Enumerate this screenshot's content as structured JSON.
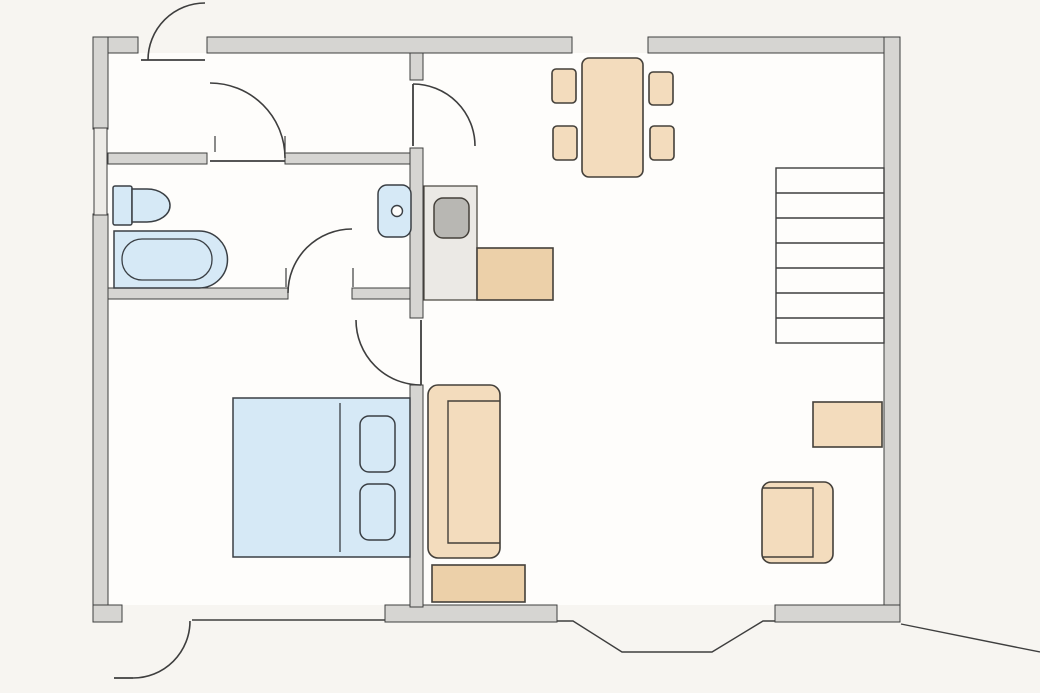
{
  "title": "apartment-floor-plan",
  "colors": {
    "exterior_bg": "#f7f5f1",
    "floor_white": "#fefdfb",
    "wall_fill": "#d6d5d2",
    "wall_stroke": "#3e3e3e",
    "window_fill": "#edebe7",
    "fixture_blue": "#d6e9f6",
    "fixture_stroke": "#3a3f44",
    "furniture_tan": "#f3dcbd",
    "furniture_tan_dark": "#ecd0a9",
    "furniture_stroke": "#44403a",
    "kitchen_unit_gray": "#ebe9e5",
    "appliance_gray": "#b8b7b3"
  },
  "stairs": {
    "steps": 7
  },
  "doors": [
    {
      "name": "back-door",
      "location": "top-left exterior wall, swings outward"
    },
    {
      "name": "hallway-bathroom-door",
      "location": "interior wall between hallway and bathroom"
    },
    {
      "name": "kitchen-door",
      "location": "interior wall between hallway and kitchen/dining area"
    },
    {
      "name": "bathroom-lower-door",
      "location": "interior wall between bathroom and bedroom area"
    },
    {
      "name": "bedroom-door",
      "location": "interior wall between bedroom and living area"
    },
    {
      "name": "front-door",
      "location": "bottom-left exterior wall, swings outward"
    }
  ],
  "windows": [
    {
      "name": "left-wall-window"
    },
    {
      "name": "top-wall-opening"
    },
    {
      "name": "bottom-picture-window"
    },
    {
      "name": "bottom-bay-window"
    }
  ],
  "furniture": [
    {
      "name": "toilet",
      "room": "bathroom"
    },
    {
      "name": "bathtub",
      "room": "bathroom"
    },
    {
      "name": "washbasin",
      "room": "bathroom"
    },
    {
      "name": "kitchen-unit",
      "room": "kitchen"
    },
    {
      "name": "stove",
      "room": "kitchen"
    },
    {
      "name": "kitchen-counter",
      "room": "kitchen"
    },
    {
      "name": "dining-table",
      "room": "dining"
    },
    {
      "name": "dining-chair",
      "count": 4,
      "room": "dining"
    },
    {
      "name": "staircase",
      "room": "living"
    },
    {
      "name": "side-table",
      "room": "living"
    },
    {
      "name": "armchair",
      "room": "living"
    },
    {
      "name": "sofa",
      "room": "living"
    },
    {
      "name": "coffee-table",
      "room": "living"
    },
    {
      "name": "double-bed",
      "room": "bedroom"
    },
    {
      "name": "pillow",
      "count": 2,
      "room": "bedroom"
    }
  ]
}
